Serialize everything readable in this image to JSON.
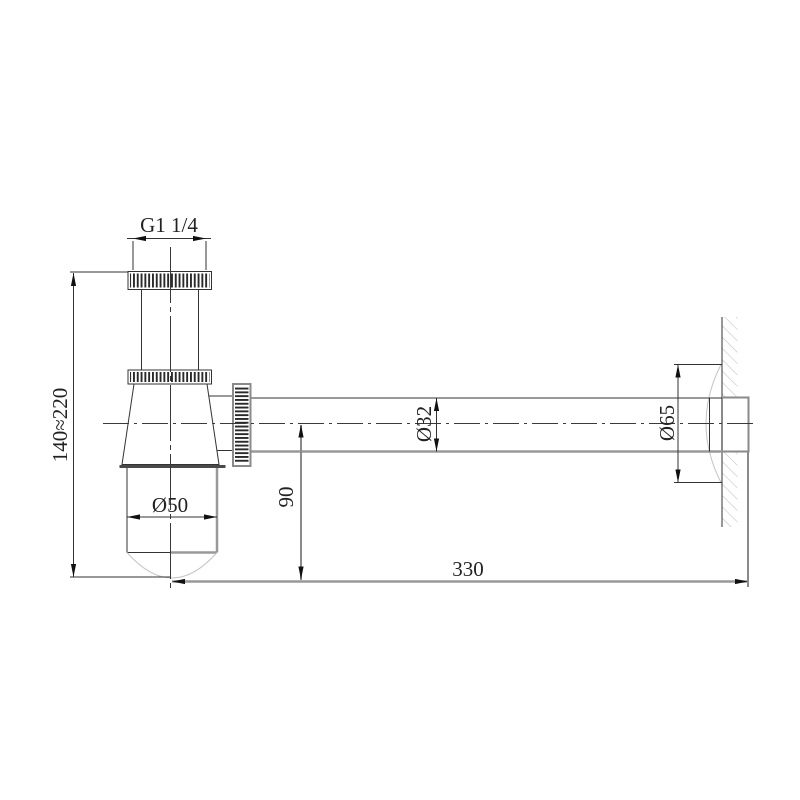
{
  "drawing": {
    "description": "Bottle trap siphon side-view technical drawing with wall connection",
    "labels": {
      "thread_size": "G1 1/4",
      "height_range": "140≈220",
      "cup_diameter": "Ø50",
      "outlet_height": "90",
      "pipe_diameter": "Ø32",
      "flange_diameter": "Ø65",
      "wall_distance": "330"
    },
    "colors": {
      "outline": "#333333",
      "thick_line": "#999999",
      "hatch": "#c4c4c4",
      "text": "#222222",
      "background": "#ffffff"
    }
  }
}
